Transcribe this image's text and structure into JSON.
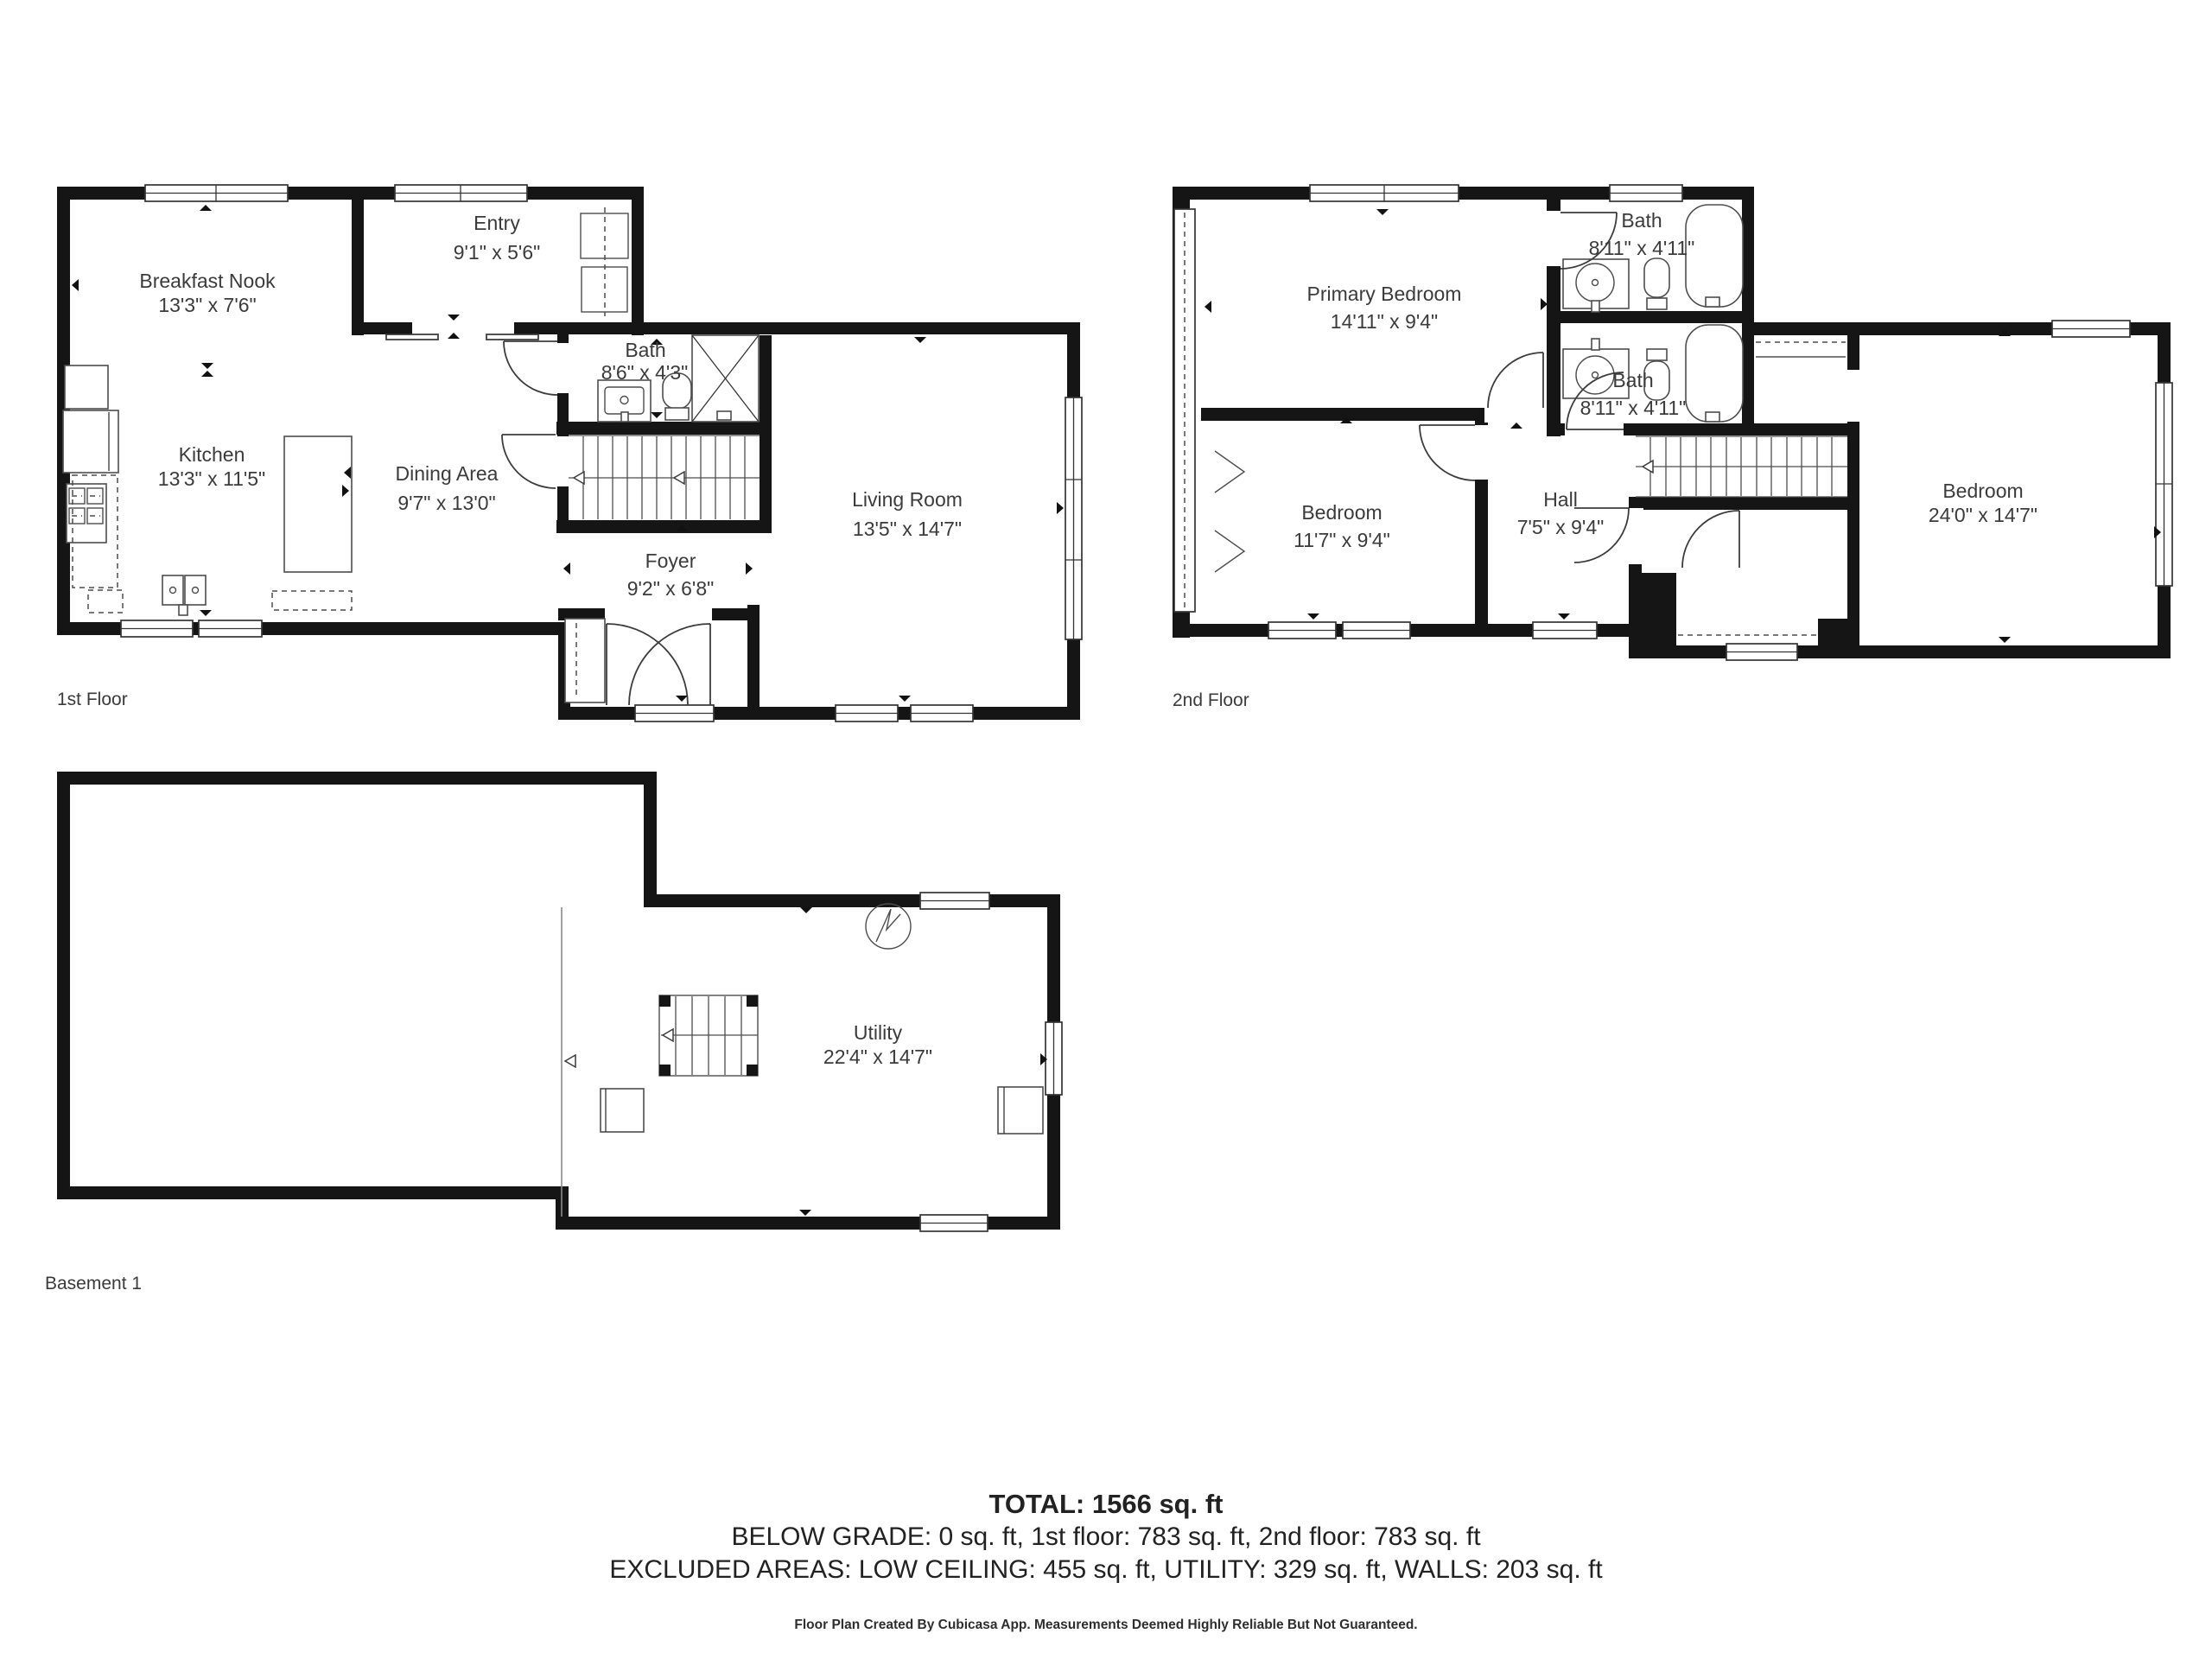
{
  "document": {
    "type": "floor-plan",
    "creator_note": "Floor Plan Created By Cubicasa App. Measurements Deemed Highly Reliable But Not Guaranteed.",
    "wall_color": "#151515",
    "text_color": "#3b3b3b",
    "background": "#ffffff"
  },
  "floors": {
    "first": {
      "label": "1st Floor",
      "rooms": {
        "breakfast_nook": {
          "name": "Breakfast Nook",
          "dims": "13'3\" x 7'6\""
        },
        "entry": {
          "name": "Entry",
          "dims": "9'1\" x 5'6\""
        },
        "bath": {
          "name": "Bath",
          "dims": "8'6\" x 4'3\""
        },
        "kitchen": {
          "name": "Kitchen",
          "dims": "13'3\" x 11'5\""
        },
        "dining": {
          "name": "Dining Area",
          "dims": "9'7\" x 13'0\""
        },
        "foyer": {
          "name": "Foyer",
          "dims": "9'2\" x 6'8\""
        },
        "living": {
          "name": "Living Room",
          "dims": "13'5\" x 14'7\""
        }
      }
    },
    "second": {
      "label": "2nd Floor",
      "rooms": {
        "primary": {
          "name": "Primary Bedroom",
          "dims": "14'11\" x 9'4\""
        },
        "bath_top": {
          "name": "Bath",
          "dims": "8'11\" x 4'11\""
        },
        "bath_bottom": {
          "name": "Bath",
          "dims": "8'11\" x 4'11\""
        },
        "bedroom_left": {
          "name": "Bedroom",
          "dims": "11'7\" x 9'4\""
        },
        "hall": {
          "name": "Hall",
          "dims": "7'5\" x 9'4\""
        },
        "bedroom_right": {
          "name": "Bedroom",
          "dims": "24'0\" x 14'7\""
        }
      }
    },
    "basement": {
      "label": "Basement 1",
      "rooms": {
        "utility": {
          "name": "Utility",
          "dims": "22'4\" x 14'7\""
        }
      }
    }
  },
  "summary": {
    "total": "TOTAL: 1566 sq. ft",
    "below_grade": "BELOW GRADE: 0 sq. ft, 1st floor: 783 sq. ft, 2nd floor: 783 sq. ft",
    "excluded": "EXCLUDED AREAS: LOW CEILING: 455 sq. ft, UTILITY: 329 sq. ft, WALLS: 203 sq. ft"
  },
  "footer": "Floor Plan Created By Cubicasa App. Measurements Deemed Highly Reliable But Not Guaranteed."
}
